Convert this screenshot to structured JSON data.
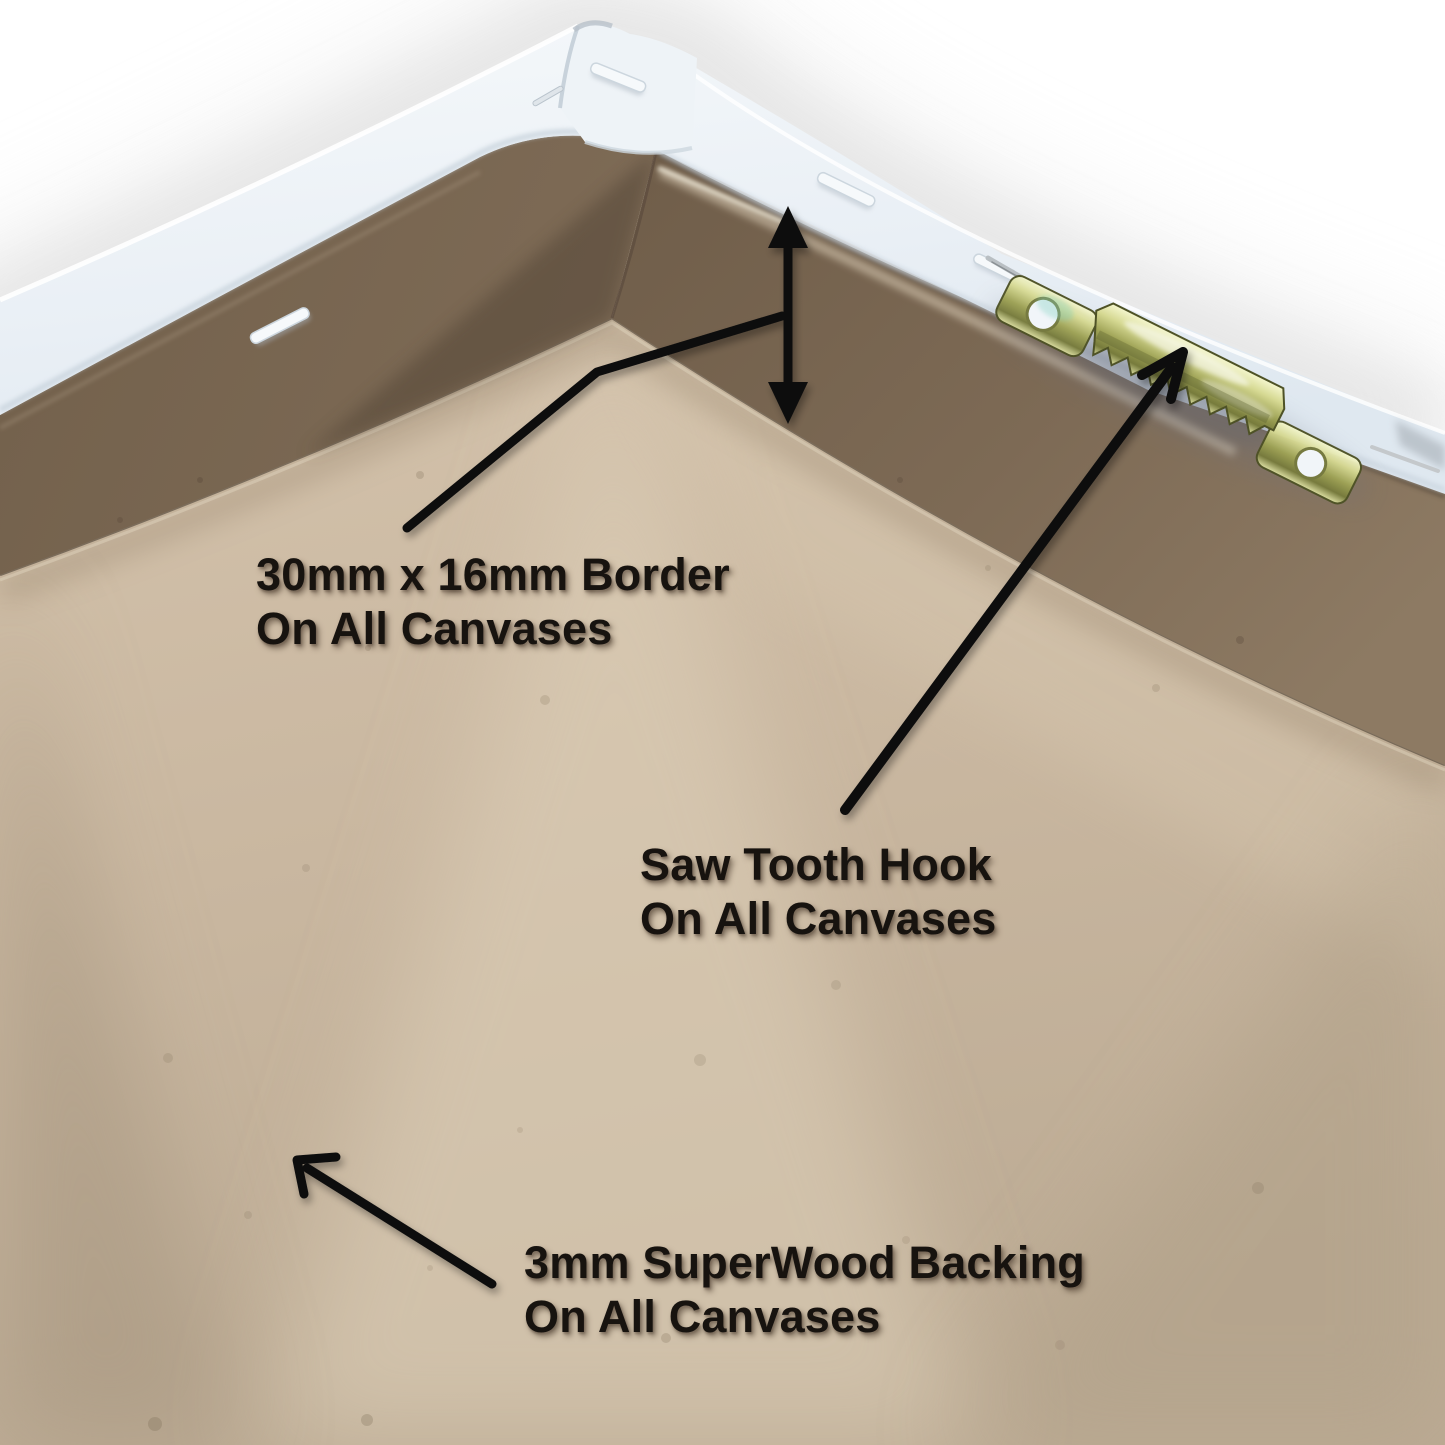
{
  "scene": {
    "description": "Rear corner view of a white stretched canvas showing the MDF border, a brass sawtooth hanging hook and the backing board",
    "background": "#ffffff"
  },
  "colors": {
    "arrow": "#0d0d0d",
    "caption_text": "#17130f",
    "canvas_edge": "#edf2f7",
    "border_wall": "#786551",
    "backing_floor": "#c9b79f",
    "hook_brass": "#c2c67e"
  },
  "annotations": {
    "border": {
      "line1": "30mm x 16mm Border",
      "line2": "On All Canvases"
    },
    "hook": {
      "line1": "Saw Tooth Hook",
      "line2": "On All Canvases"
    },
    "backing": {
      "line1": "3mm SuperWood Backing",
      "line2": "On All Canvases"
    }
  }
}
